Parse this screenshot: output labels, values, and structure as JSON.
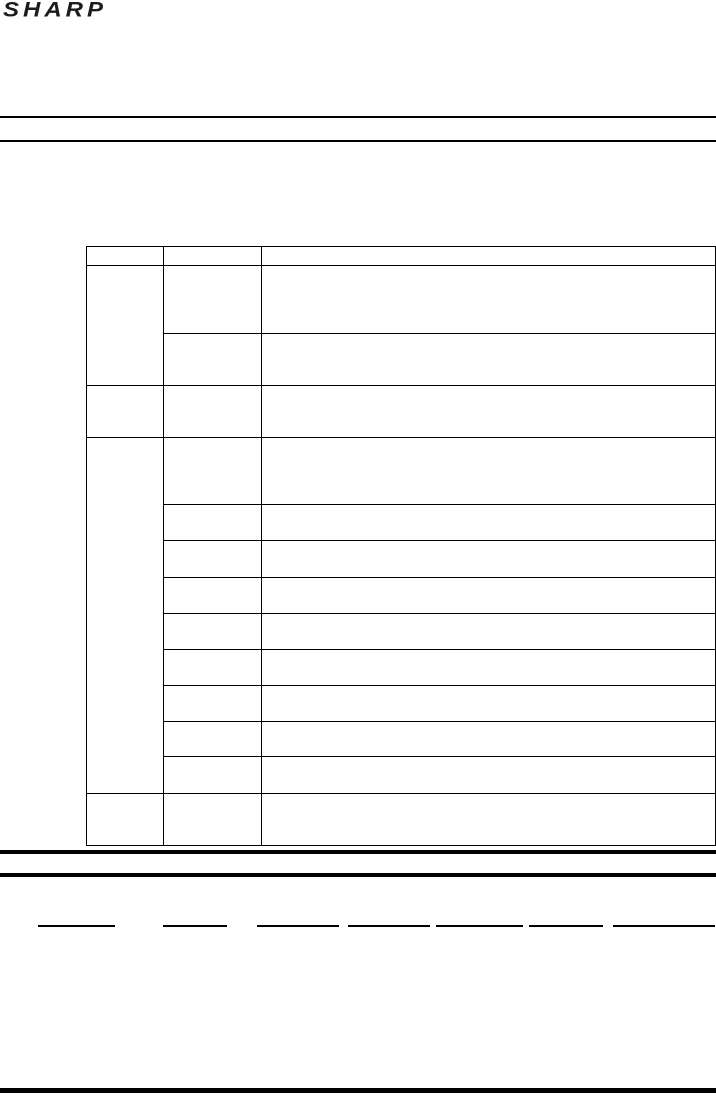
{
  "page": {
    "logo_text": "SHARP"
  },
  "colors": {
    "ink": "#000000",
    "logo": "#1c1c1c",
    "background": "#ffffff"
  },
  "table": {
    "columns": 3,
    "header_cells": [
      "",
      "",
      ""
    ],
    "cells_visible_text": ""
  }
}
